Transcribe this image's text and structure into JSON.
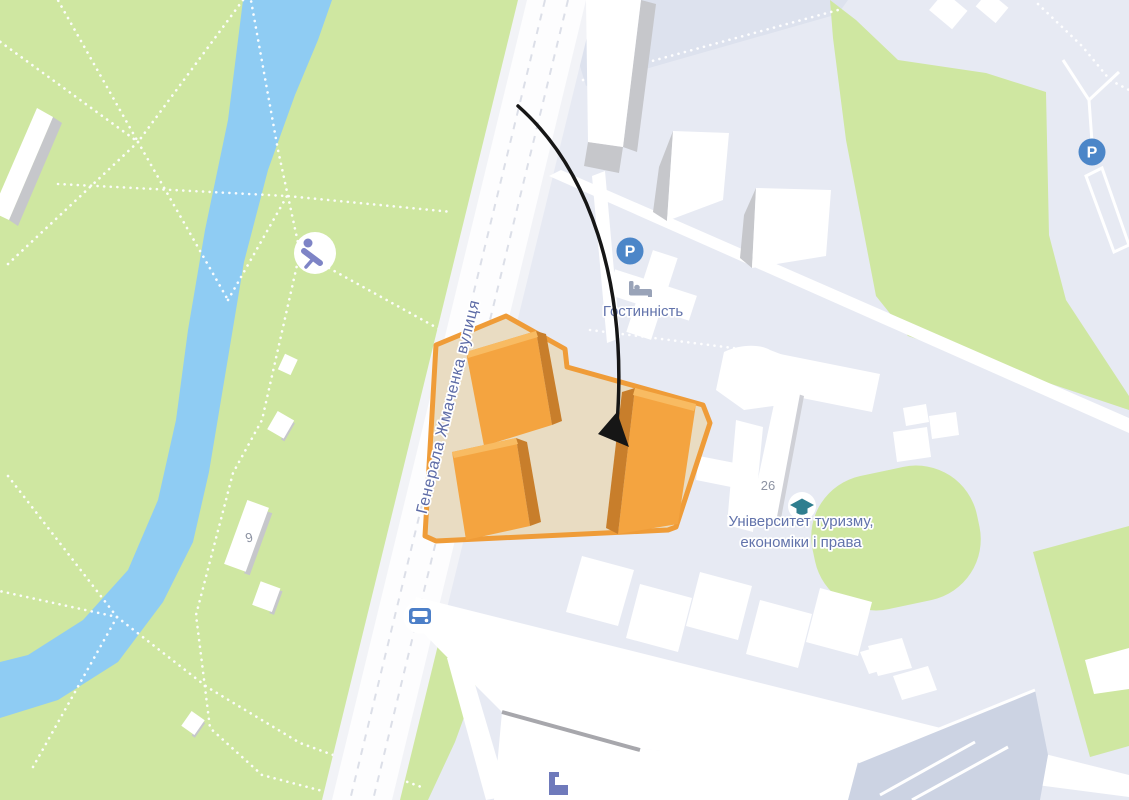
{
  "map": {
    "street": {
      "name": "Генерала Жмаченка вулиця"
    },
    "pois": {
      "hotel": {
        "label": "Гостинність",
        "icon": "hotel-bed-icon"
      },
      "university": {
        "label_line1": "Університет туризму,",
        "label_line2": "економіки і права",
        "icon": "graduation-cap-icon"
      },
      "playground": {
        "icon": "playground-icon"
      },
      "traffic": {
        "icon": "car-icon"
      },
      "parking_north": {
        "symbol": "P",
        "icon": "parking-icon"
      },
      "parking_northeast": {
        "symbol": "P",
        "icon": "parking-icon"
      },
      "campus_building": {
        "icon": "building-icon"
      }
    },
    "building_numbers": {
      "university": "26",
      "park": "9"
    },
    "colors": {
      "park_green": "#cfe7a1",
      "river_blue": "#8fccf3",
      "campus_base": "#e7eaf3",
      "campus_shade": "#dde2ee",
      "road_white": "#ffffff",
      "building_white": "#ffffff",
      "building_shadow": "#c6c7cb",
      "parking_lot": "#ccd3e3",
      "highlight_outline": "#ef9c38",
      "highlight_fill": "#e9dcc2",
      "building_orange": "#f4a440",
      "building_orange_dark": "#c87e2b",
      "building_orange_light": "#f8bb62",
      "poi_blue": "#4c86c8",
      "poi_teal": "#2f7e8f",
      "poi_purple": "#7e84c6",
      "label_blue": "#6273ab",
      "street_label_blue": "#5d6ba6",
      "number_gray": "#8d93a3",
      "arrow_black": "#161616"
    }
  }
}
